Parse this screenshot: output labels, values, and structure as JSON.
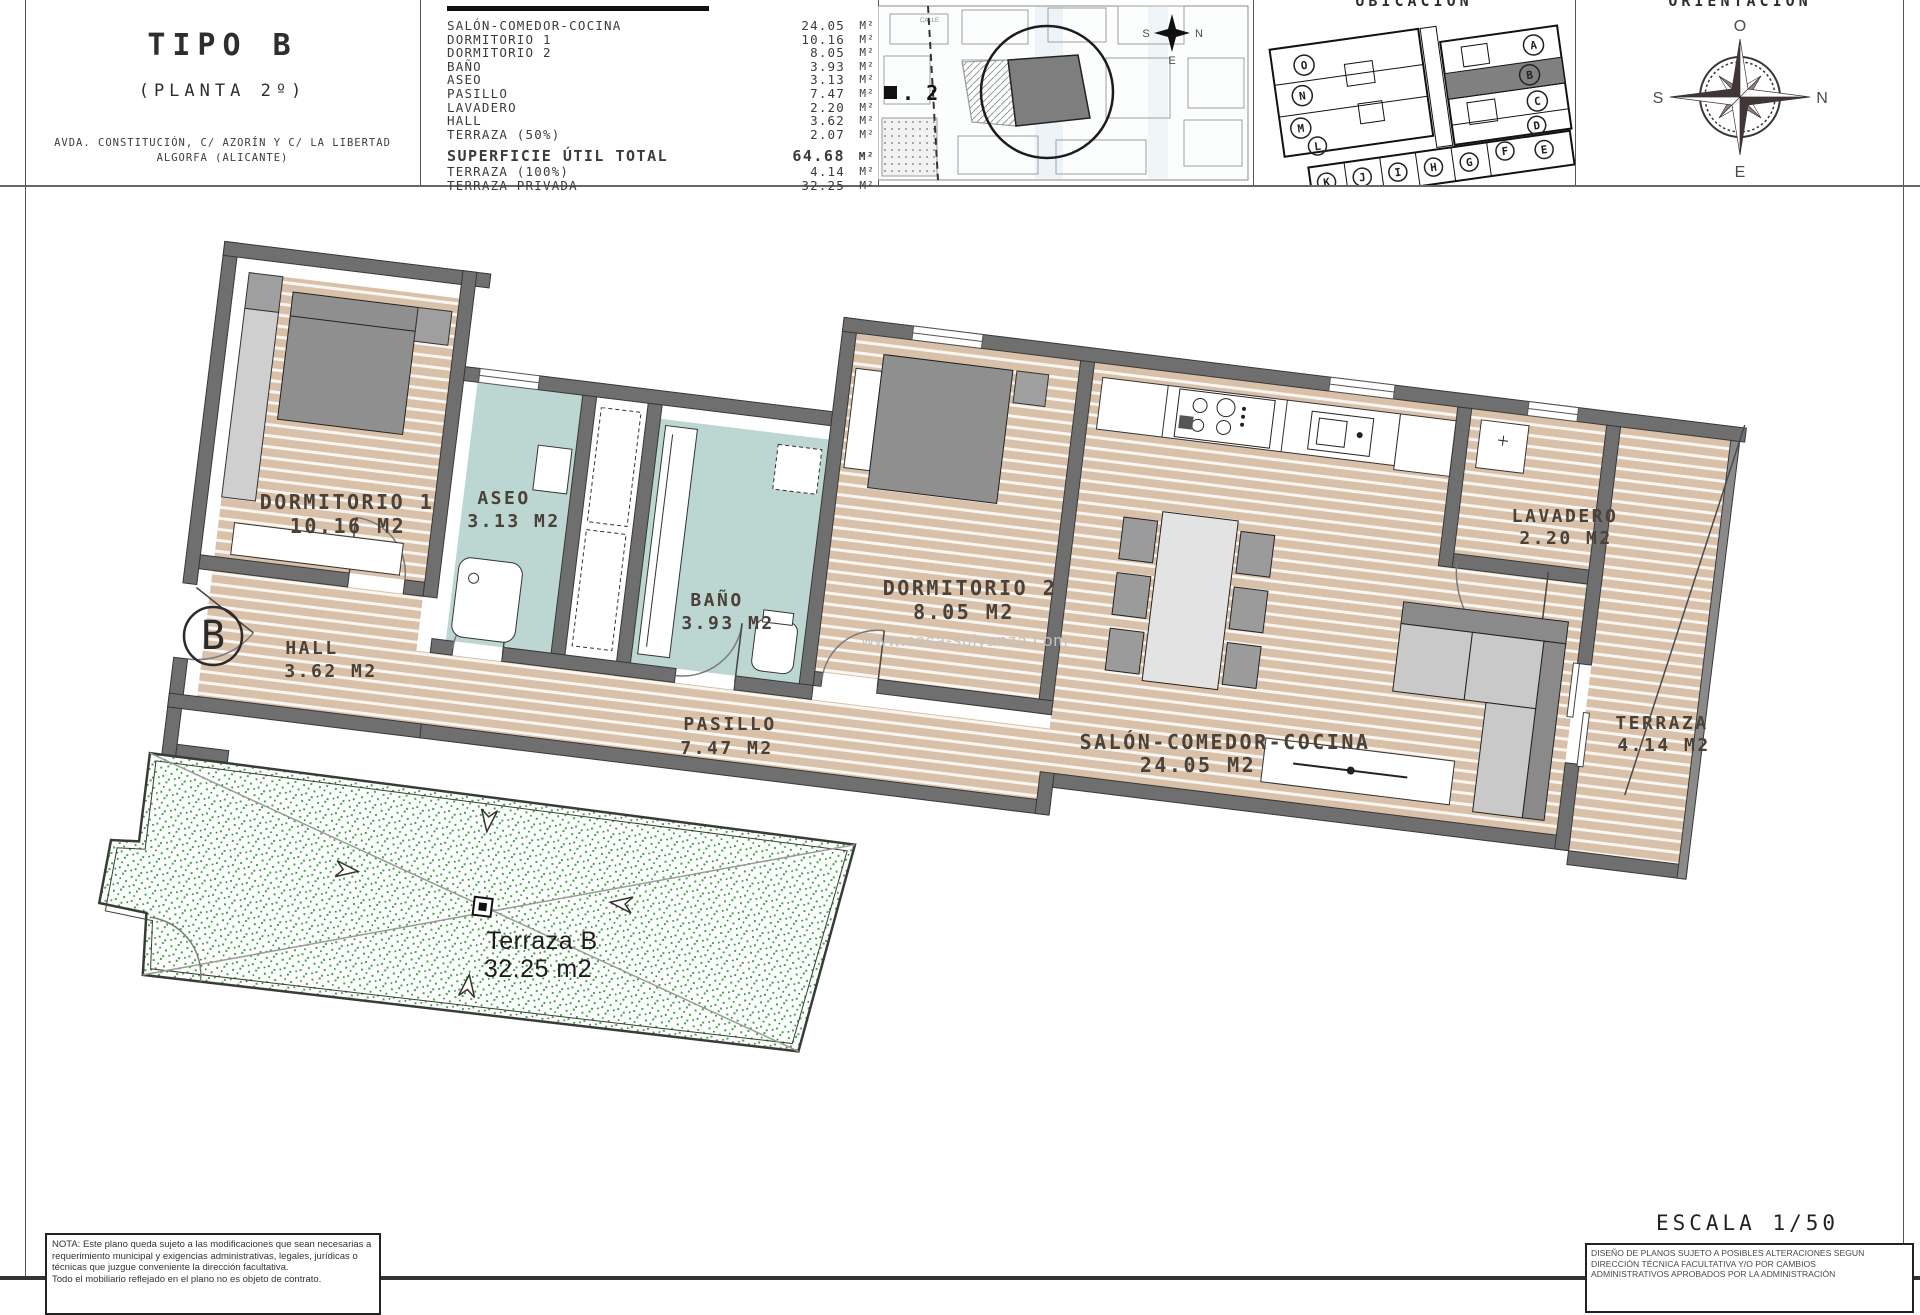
{
  "header": {
    "title": "TIPO B",
    "subtitle": "(PLANTA 2º)",
    "address_line1": "AVDA. CONSTITUCIÓN, C/ AZORÍN Y C/ LA LIBERTAD",
    "address_line2": "ALGORFA (ALICANTE)",
    "ubicacion_title": "UBICACIÓN",
    "orientacion_title": "ORIENTACIÓN",
    "sitemap": {
      "street_label": "CALLE",
      "plot_label": ". 2",
      "mini_compass": {
        "left": "S",
        "right": "N",
        "bottom": "E"
      }
    },
    "compass": {
      "top": "O",
      "right": "N",
      "left": "S",
      "bottom": "E"
    },
    "units": [
      "O",
      "N",
      "M",
      "L",
      "A",
      "B",
      "C",
      "D",
      "K",
      "J",
      "I",
      "H",
      "G",
      "F",
      "E"
    ],
    "highlighted_unit": "B"
  },
  "area_table": {
    "rows": [
      {
        "label": "SALÓN-COMEDOR-COCINA",
        "value": "24.05",
        "unit": "M²"
      },
      {
        "label": "DORMITORIO 1",
        "value": "10.16",
        "unit": "M²"
      },
      {
        "label": "DORMITORIO 2",
        "value": "8.05",
        "unit": "M²"
      },
      {
        "label": "BAÑO",
        "value": "3.93",
        "unit": "M²"
      },
      {
        "label": "ASEO",
        "value": "3.13",
        "unit": "M²"
      },
      {
        "label": "PASILLO",
        "value": "7.47",
        "unit": "M²"
      },
      {
        "label": "LAVADERO",
        "value": "2.20",
        "unit": "M²"
      },
      {
        "label": "HALL",
        "value": "3.62",
        "unit": "M²"
      },
      {
        "label": "TERRAZA (50%)",
        "value": "2.07",
        "unit": "M²"
      }
    ],
    "totals": [
      {
        "label": "SUPERFICIE ÚTIL TOTAL",
        "value": "64.68",
        "unit": "M²"
      },
      {
        "label": "TERRAZA (100%)",
        "value": "4.14",
        "unit": "M²"
      },
      {
        "label": "TERRAZA PRIVADA",
        "value": "32.25",
        "unit": "M²"
      }
    ]
  },
  "plan": {
    "unit_marker": "B",
    "watermark": "www.casa-solyanza.com",
    "rooms": {
      "dorm1": {
        "name": "DORMITORIO 1",
        "area": "10.16 M2"
      },
      "aseo": {
        "name": "ASEO",
        "area": "3.13 M2"
      },
      "hall": {
        "name": "HALL",
        "area": "3.62 M2"
      },
      "bano": {
        "name": "BAÑO",
        "area": "3.93 M2"
      },
      "pasillo": {
        "name": "PASILLO",
        "area": "7.47 M2"
      },
      "dorm2": {
        "name": "DORMITORIO 2",
        "area": "8.05 M2"
      },
      "salon": {
        "name": "SALÓN-COMEDOR-COCINA",
        "area": "24.05 M2"
      },
      "lavadero": {
        "name": "LAVADERO",
        "area": "2.20 M2"
      },
      "terraza": {
        "name": "TERRAZA",
        "area": "4.14 M2"
      }
    },
    "terrace_b": {
      "name": "Terraza B",
      "area": "32.25 m2"
    }
  },
  "footer": {
    "nota_lines": [
      "NOTA: Este plano queda sujeto a las modificaciones que sean necesarias a",
      "requerimiento municipal y exigencias administrativas, legales, jurídicas o",
      "técnicas que juzgue conveniente la dirección facultativa.",
      "Todo el mobiliario reflejado en el plano no es objeto de contrato."
    ],
    "escala": "ESCALA 1/50",
    "disclaimer_lines": [
      "DISEÑO DE PLANOS SUJETO A POSIBLES ALTERACIONES SEGUN",
      "DIRECCIÓN TÉCNICA FACULTATIVA Y/O POR CAMBIOS",
      "ADMINISTRATIVOS APROBADOS POR LA ADMINISTRACIÓN"
    ]
  },
  "colors": {
    "floor_tan": "#d9c0a9",
    "floor_wet": "#bcd6d1",
    "wall": "#6f6f6f",
    "terrace_green": "#4aa34a",
    "label": "#4a4138",
    "watermark": "#c2c2c2"
  }
}
